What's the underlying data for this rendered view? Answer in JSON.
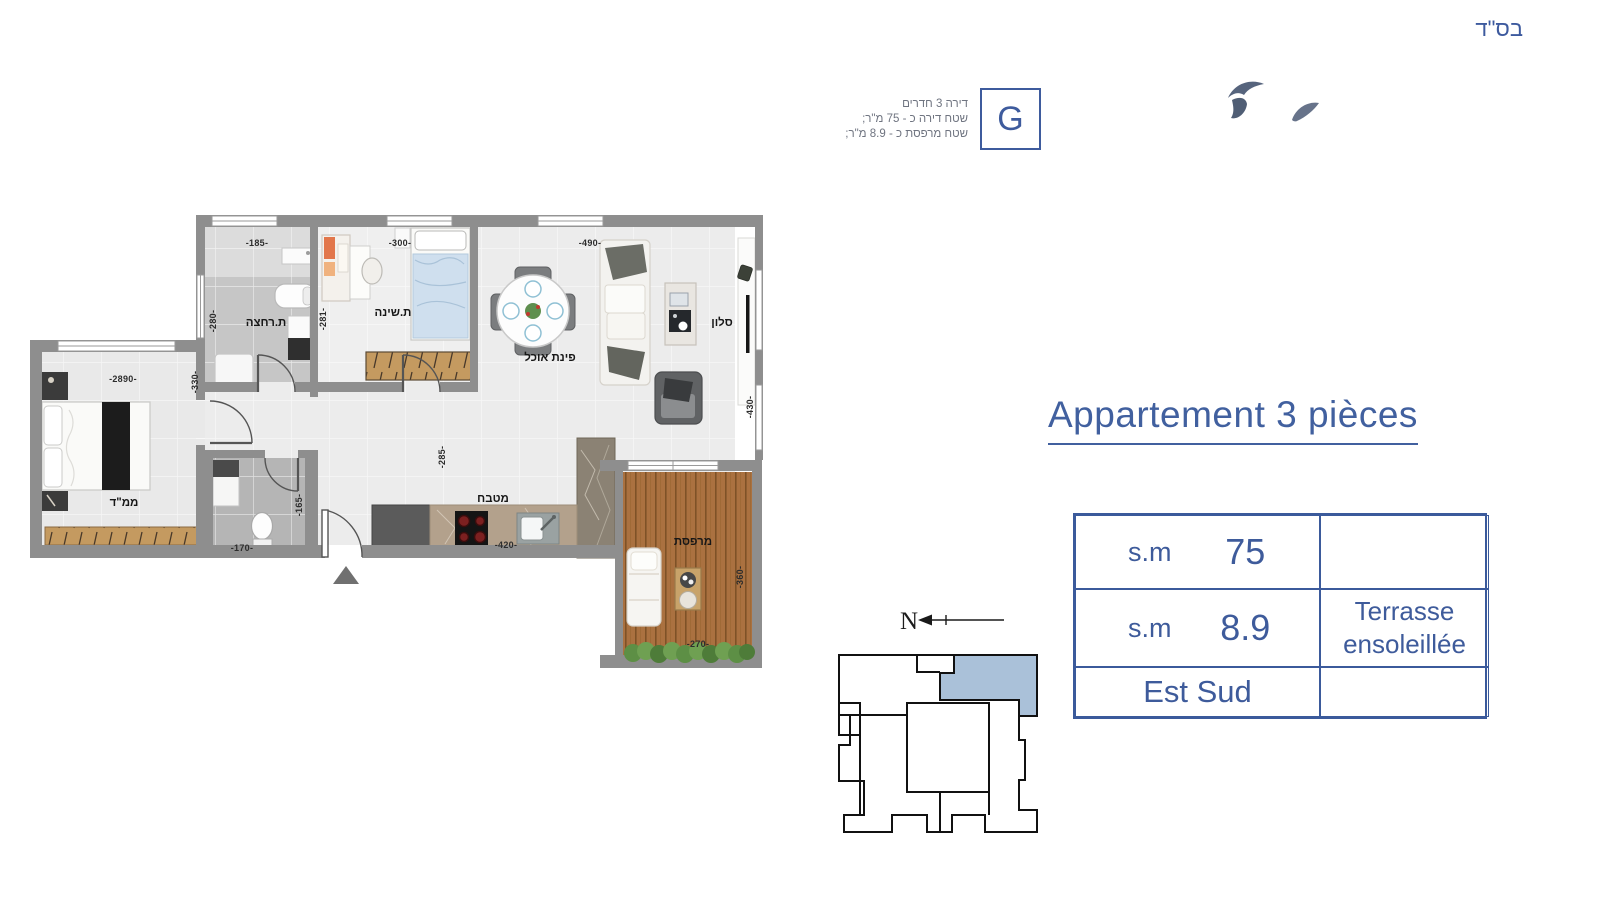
{
  "colors": {
    "accent_blue": "#3e5b9d",
    "keyplan_highlight": "#aac1d9",
    "wall_gray": "#8e8e8e",
    "terrace_wood": "#aa7140"
  },
  "header": {
    "bsd": "בס\"ד"
  },
  "unit_info": {
    "lines": [
      "דירה 3 חדרים",
      "שטח דירה כ - 75 מ\"ר;",
      "שטח מרפסת כ - 8.9 מ\"ר;"
    ],
    "unit_letter": "G"
  },
  "title": "Appartement 3 pièces",
  "spec_table": {
    "row1": {
      "label": "s.m",
      "value": "75"
    },
    "row2": {
      "label": "s.m",
      "value": "8.9",
      "note_line1": "Terrasse",
      "note_line2": "ensoleillée"
    },
    "row3": {
      "label": "Est Sud"
    }
  },
  "keyplan": {
    "north": "N"
  },
  "plan": {
    "rooms": {
      "bathroom": "ת.רחצה",
      "bedroom": "ת.שינה",
      "living": "סלון",
      "dining": "פינת אוכל",
      "kitchen": "מטבח",
      "terrace": "מרפסת",
      "safe_room": "ממ\"ד"
    },
    "dims": {
      "d185": "-185-",
      "d300": "-300-",
      "d490": "-490-",
      "d280": "-280-",
      "d281": "-281-",
      "d330": "-330-",
      "d2890": "-2890-",
      "d430": "-430-",
      "d285": "-285-",
      "d420": "-420-",
      "d170": "-170-",
      "d165": "-165-",
      "d270": "-270-",
      "d360": "-360-"
    }
  }
}
